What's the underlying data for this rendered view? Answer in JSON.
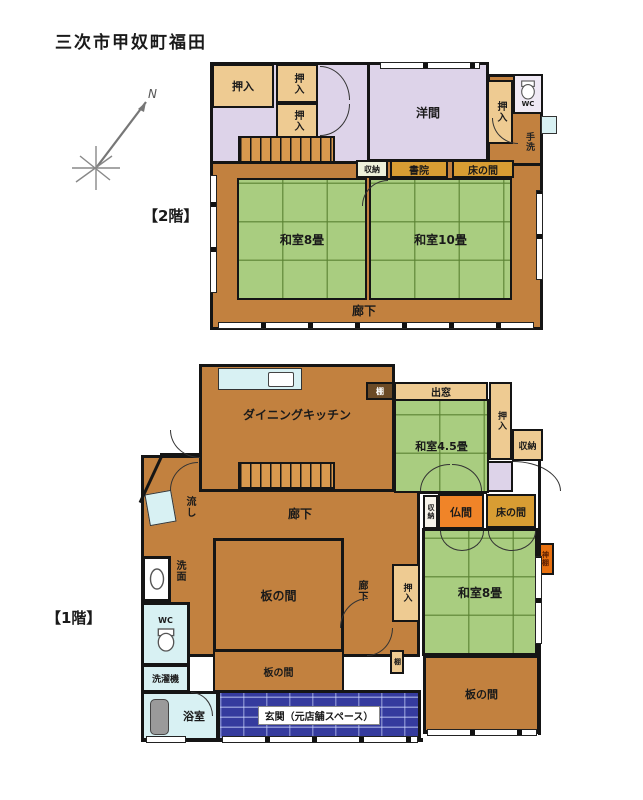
{
  "title": "三次市甲奴町福田",
  "labels": {
    "floor2": "【2階】",
    "floor1": "【1階】",
    "north": "N"
  },
  "rooms": {
    "oshiire": "押入",
    "shuunou": "収納",
    "rouka": "廊下",
    "itanoma": "板の間",
    "tokonoma": "床の間",
    "tana": "棚",
    "youma": "洋間",
    "shoin": "書院",
    "washitsu8": "和室8畳",
    "washitsu10": "和室10畳",
    "tearai": "手洗",
    "wc": "WC",
    "dk": "ダイニングキッチン",
    "demado": "出窓",
    "washitsu45": "和室4.5畳",
    "butsuma": "仏間",
    "kamidana": "神棚",
    "nagashi": "流し",
    "senmen": "洗面",
    "sentakuki": "洗濯機",
    "yokushitsu": "浴室",
    "genkan": "玄関（元店舗スペース）"
  },
  "colors": {
    "tatami_green": "#a9cd80",
    "wood_brown": "#c2813f",
    "western_lavender": "#ddd3e9",
    "closet_tan": "#eecb92",
    "alcove_gold": "#d89d33",
    "butsuma_orange": "#f08428",
    "wetroom_aqua": "#d8f1f3",
    "entrance_brick_blue": "#353b9e",
    "stair_orange": "#d9994e",
    "kamidana_orange": "#e8700f",
    "wall_black": "#151515"
  }
}
